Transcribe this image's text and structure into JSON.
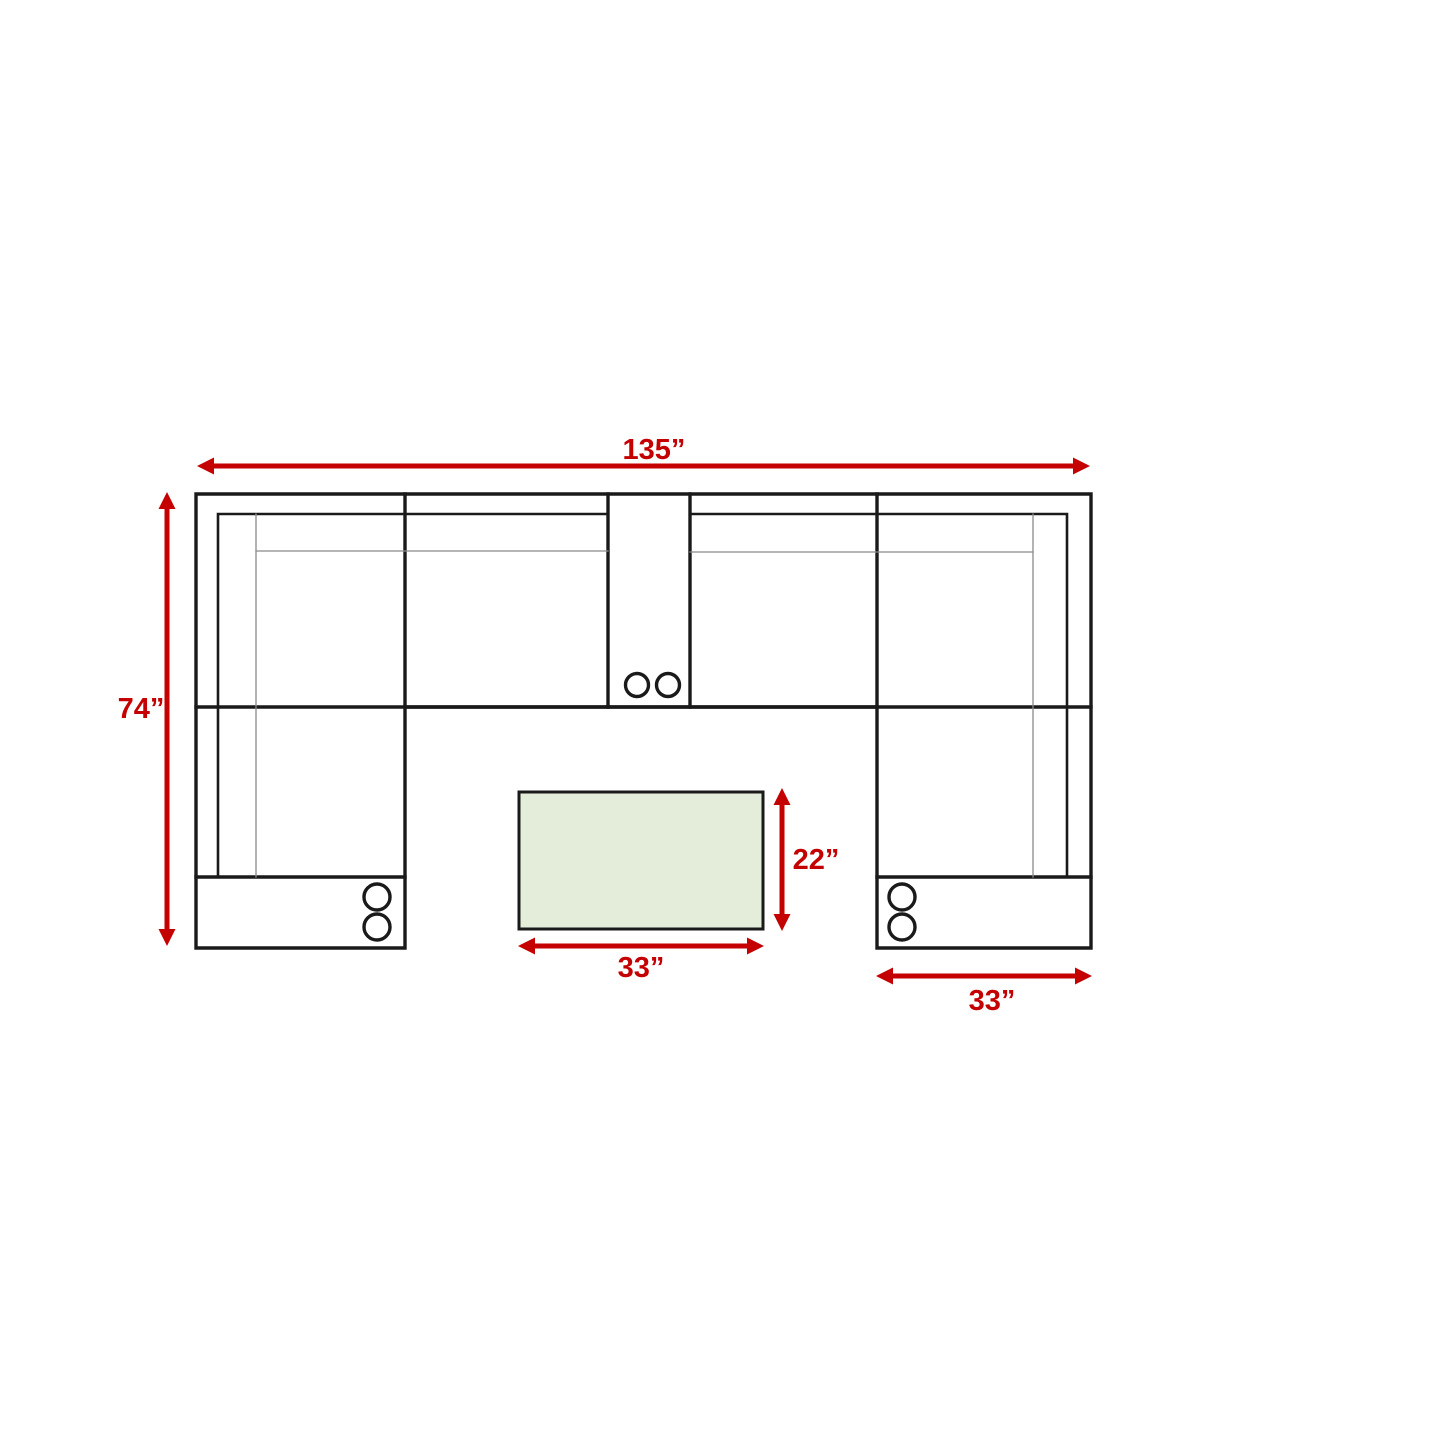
{
  "page": {
    "background": "#ffffff",
    "description": "Top-view floor plan diagram of a U-shaped sectional sofa with center console cupholders, two chaise ends, and a rectangular ottoman, annotated with red dimension arrows"
  },
  "colors": {
    "dimension_red": "#c40000",
    "outline_black": "#1a1a1a",
    "detail_gray": "#8a8a8a",
    "ottoman_fill": "#e3edd9",
    "background": "#ffffff"
  },
  "dimensions": {
    "overall_width": {
      "label": "135”",
      "value_in": 135
    },
    "overall_depth": {
      "label": "74”",
      "value_in": 74
    },
    "ottoman_width": {
      "label": "33”",
      "value_in": 33
    },
    "ottoman_depth": {
      "label": "22”",
      "value_in": 22
    },
    "right_chaise_width": {
      "label": "33”",
      "value_in": 33
    }
  }
}
